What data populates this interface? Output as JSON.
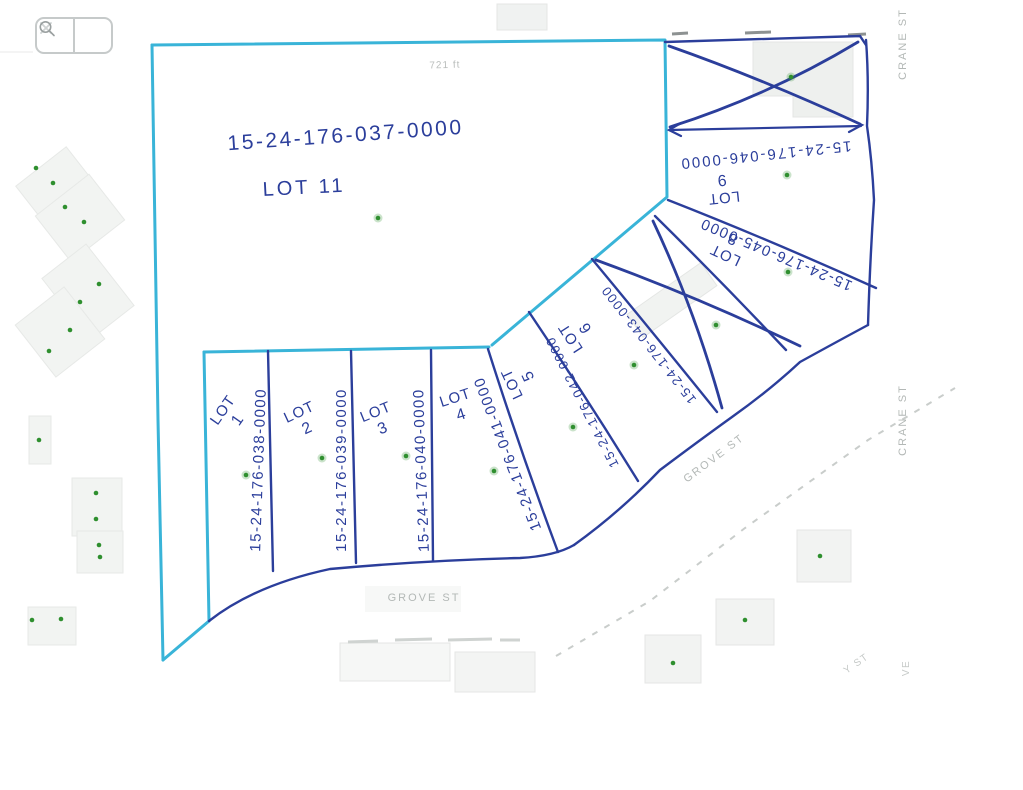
{
  "viewer": {
    "toolbar": {
      "close_icon": "x-icon",
      "search_icon": "magnifier-icon"
    }
  },
  "map": {
    "measurement_label": "721 ft",
    "streets": {
      "grove_bottom": "GROVE ST",
      "grove_diagonal": "GROVE ST",
      "crane_top": "CRANE ST",
      "crane_middle": "CRANE ST",
      "partial_bottom_right_diag": "Y ST",
      "partial_bottom_right_vert": "VE"
    },
    "lots": {
      "lot11": {
        "label": "LOT 11",
        "parcel": "15-24-176-037-0000"
      },
      "lot1": {
        "label": "LOT",
        "number": "1",
        "parcel": "15-24-176-038-0000"
      },
      "lot2": {
        "label": "LOT",
        "number": "2",
        "parcel": "15-24-176-039-0000"
      },
      "lot3": {
        "label": "LOT",
        "number": "3",
        "parcel": "15-24-176-040-0000"
      },
      "lot4": {
        "label": "LOT",
        "number": "4",
        "parcel": "15-24-176-041-0000"
      },
      "lot5": {
        "label": "LOT",
        "number": "5",
        "parcel": "15-24-176-042-0000"
      },
      "lot6": {
        "label": "LOT",
        "number": "6",
        "parcel": "15-24-176-043-0000"
      },
      "lot8": {
        "label": "LOT",
        "number": "8",
        "parcel": "15-24-176-045-0000"
      },
      "lot9": {
        "label": "LOT",
        "number": "9",
        "parcel": "15-24-176-046-0000"
      }
    },
    "colors": {
      "boundary_teal": "#39b4d8",
      "ink_blue": "#2b3e9b",
      "marker_green": "#2f8f2f",
      "street_gray": "#b3b8b6"
    }
  }
}
